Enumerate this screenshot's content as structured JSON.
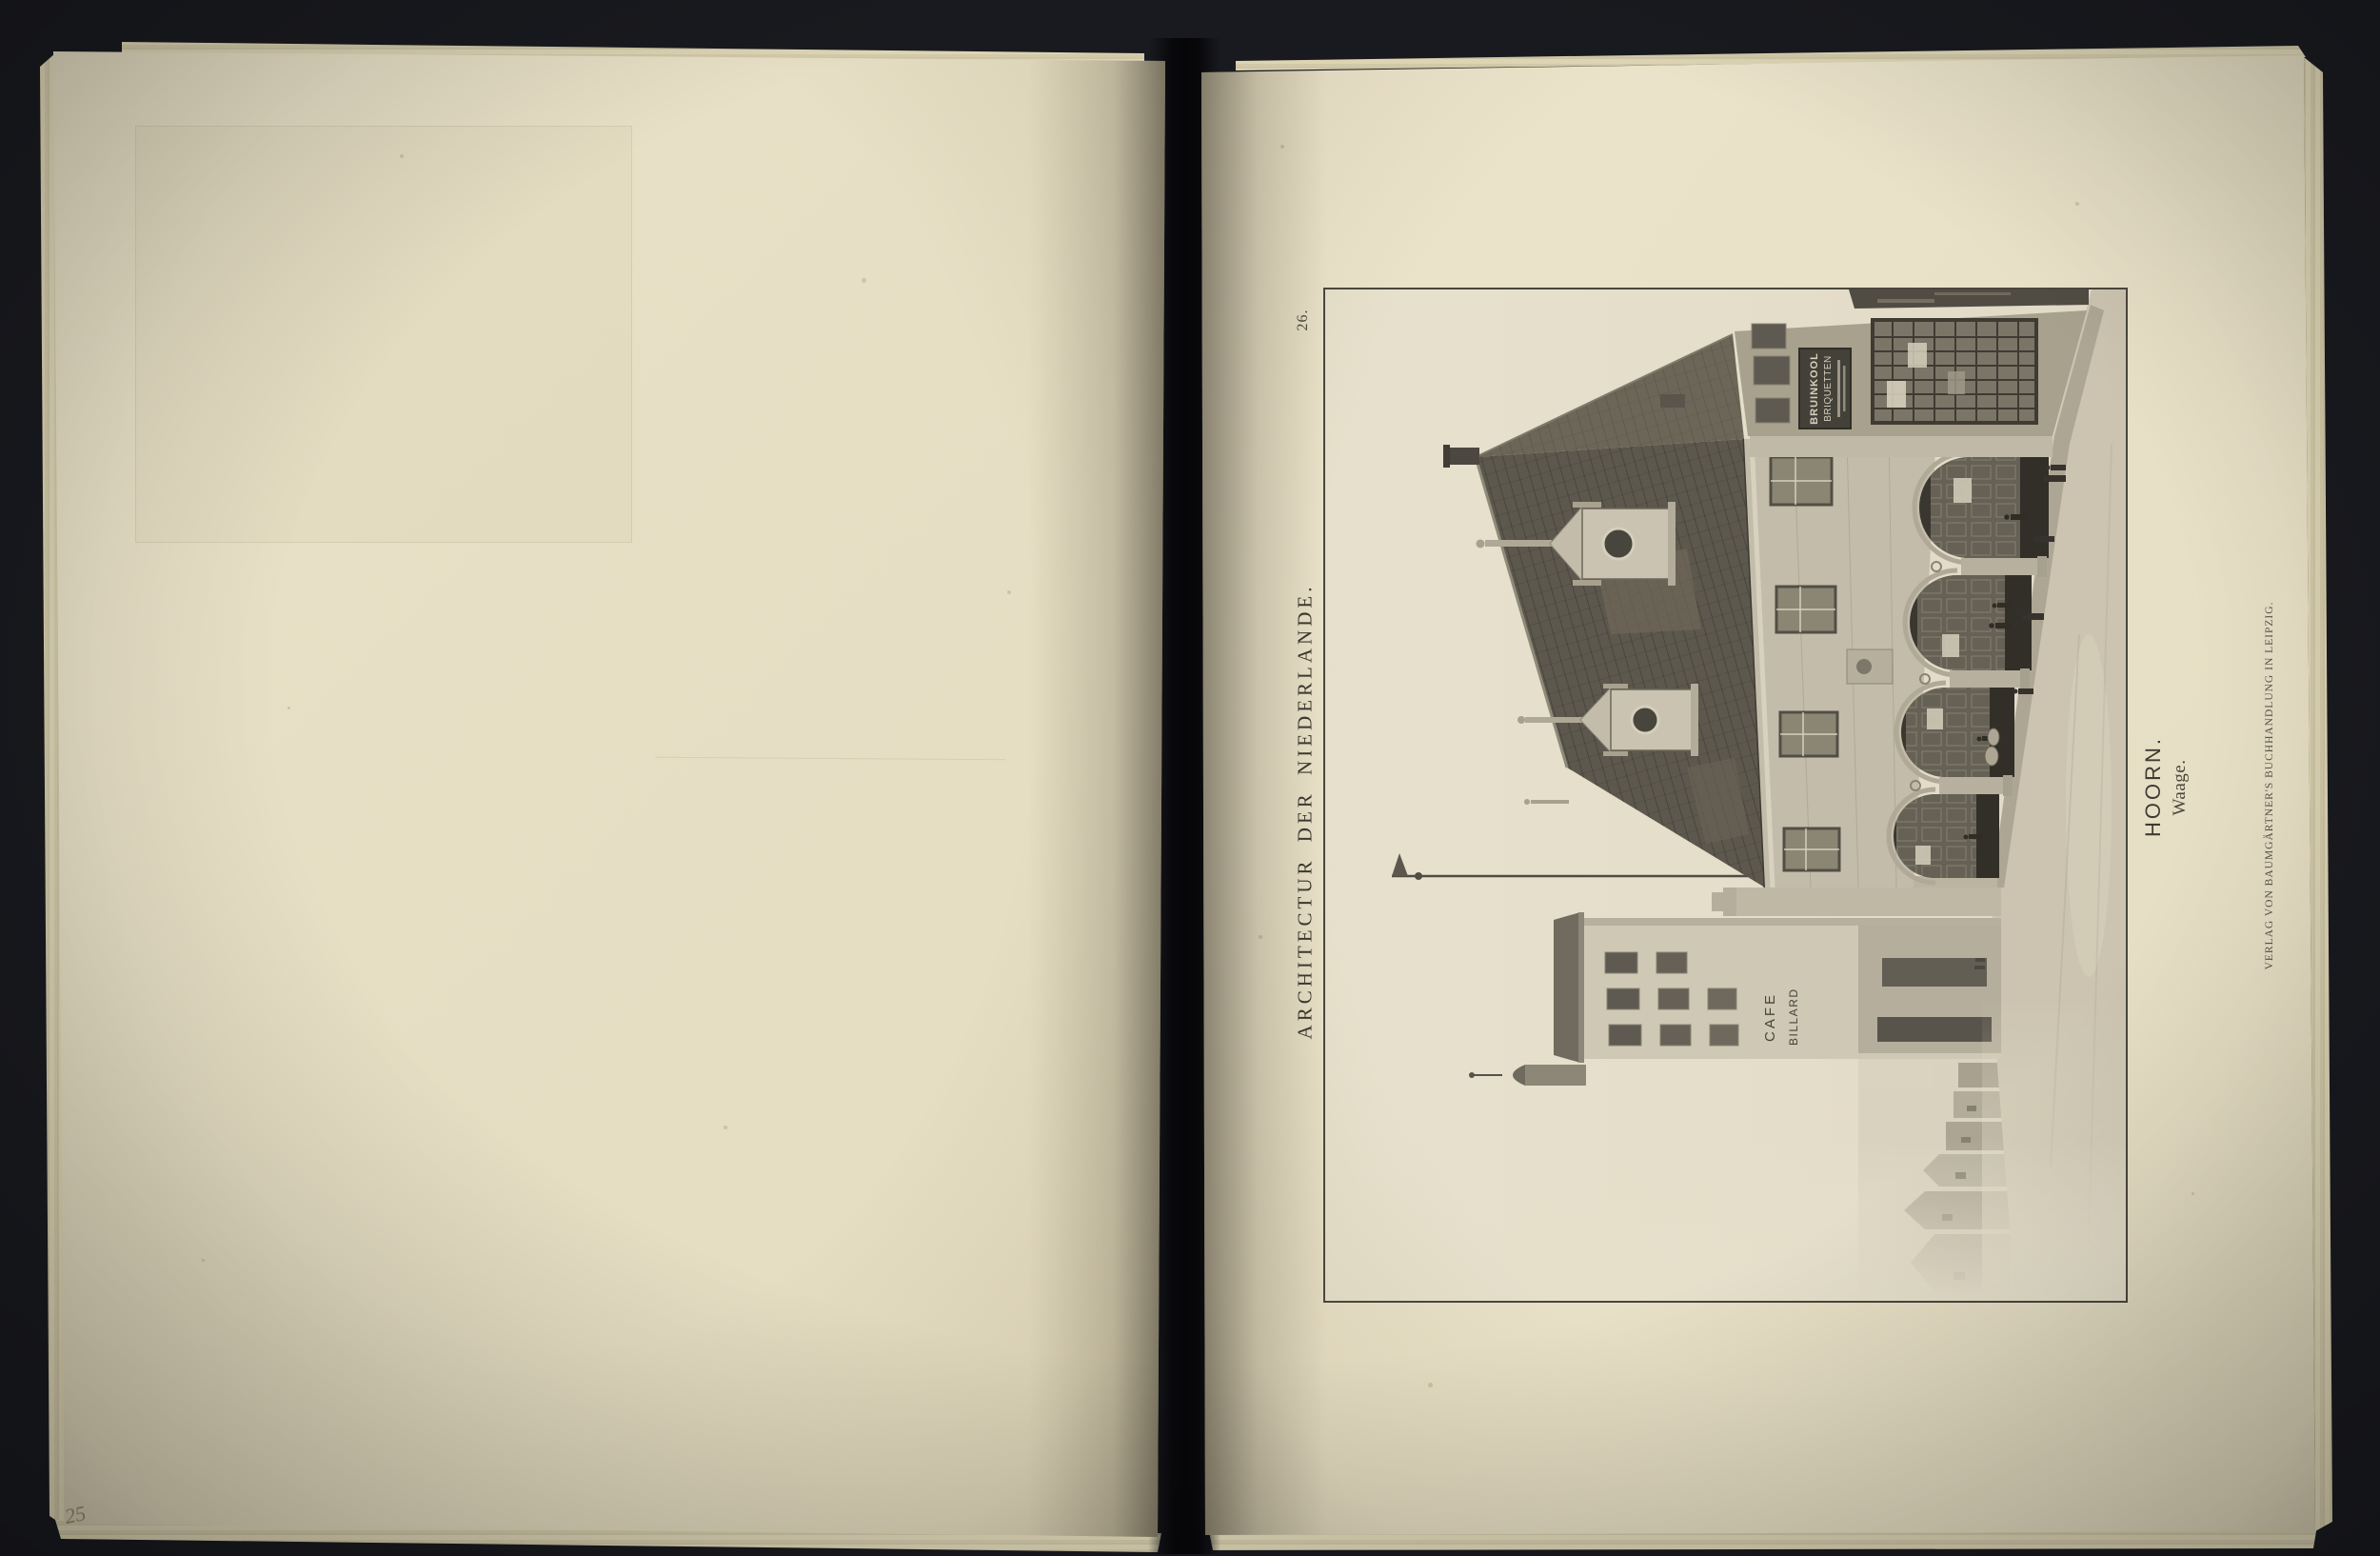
{
  "book": {
    "left_page": {
      "handwritten_number": "25"
    },
    "right_page": {
      "plate_number": "26.",
      "series_title": "ARCHITECTUR DER NIEDERLANDE.",
      "caption_title": "HOORN.",
      "caption_subtitle": "Waage.",
      "publisher_imprint": "VERLAG VON BAUMGÄRTNER'S BUCHHANDLUNG IN LEIPZIG.",
      "photo_signs": {
        "board_line1": "BRUINKOOL",
        "board_line2": "BRIQUETTEN",
        "cafe_line1": "CAFE",
        "cafe_line2": "BILLARD"
      }
    }
  },
  "colors": {
    "background": "#191a1f",
    "paper_left": "#e6dec3",
    "paper_right": "#eae2c9",
    "sheet_edge": "#d5ccac",
    "frame_line": "#4a463c",
    "printed_ink": "#3d3930",
    "pencil": "#8f8669",
    "photo_dark": "#39362d",
    "photo_sky": "#ebe4cf"
  }
}
